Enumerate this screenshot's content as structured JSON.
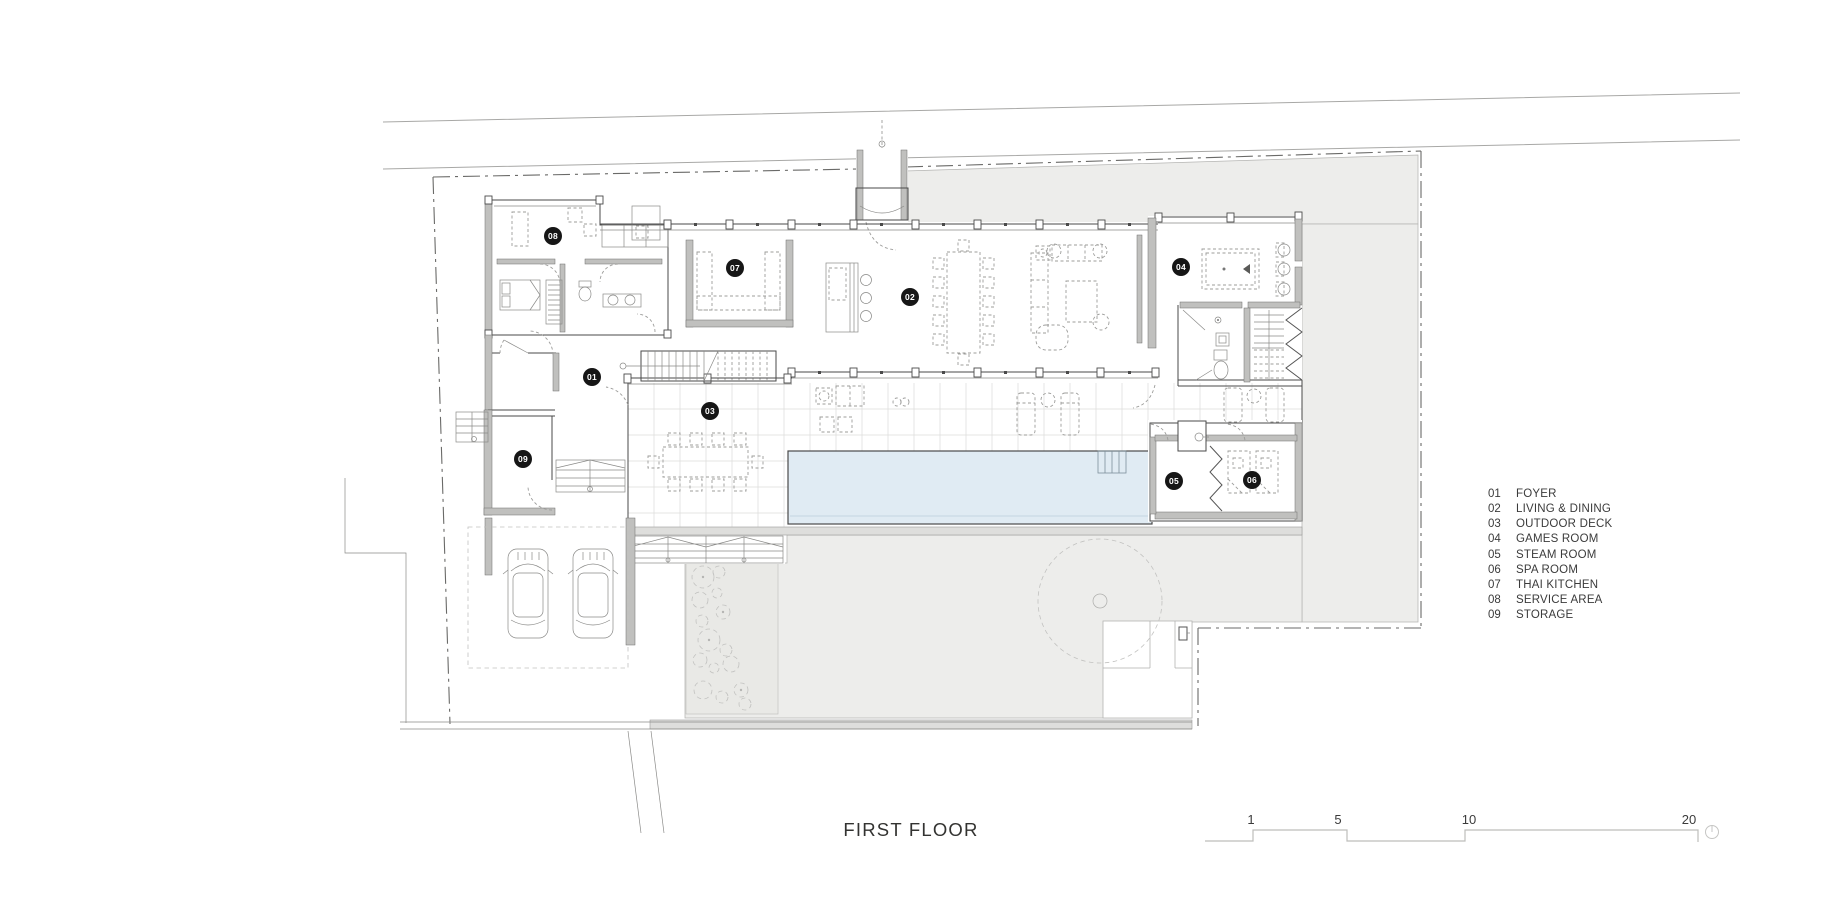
{
  "title": {
    "label": "FIRST FLOOR"
  },
  "legend": {
    "items": [
      {
        "num": "01",
        "label": "FOYER"
      },
      {
        "num": "02",
        "label": "LIVING & DINING"
      },
      {
        "num": "03",
        "label": "OUTDOOR DECK"
      },
      {
        "num": "04",
        "label": "GAMES ROOM"
      },
      {
        "num": "05",
        "label": "STEAM ROOM"
      },
      {
        "num": "06",
        "label": "SPA ROOM"
      },
      {
        "num": "07",
        "label": "THAI KITCHEN"
      },
      {
        "num": "08",
        "label": "SERVICE AREA"
      },
      {
        "num": "09",
        "label": "STORAGE"
      }
    ]
  },
  "room_badges": [
    {
      "num": "01",
      "x": 592,
      "y": 377
    },
    {
      "num": "02",
      "x": 910,
      "y": 297
    },
    {
      "num": "03",
      "x": 710,
      "y": 411
    },
    {
      "num": "04",
      "x": 1181,
      "y": 267
    },
    {
      "num": "05",
      "x": 1174,
      "y": 481
    },
    {
      "num": "06",
      "x": 1252,
      "y": 480
    },
    {
      "num": "07",
      "x": 735,
      "y": 268
    },
    {
      "num": "08",
      "x": 553,
      "y": 236
    },
    {
      "num": "09",
      "x": 523,
      "y": 459
    }
  ],
  "scale_bar": {
    "labels": [
      {
        "text": "1",
        "x": 1251
      },
      {
        "text": "5",
        "x": 1338
      },
      {
        "text": "10",
        "x": 1469
      },
      {
        "text": "20",
        "x": 1689
      }
    ]
  },
  "colors": {
    "site_ground": "#ededeb",
    "pool_water": "#e0ebf3",
    "badge_bg": "#161616",
    "wall_dark": "#4a4a4a",
    "label_text": "#3b3b3b"
  }
}
